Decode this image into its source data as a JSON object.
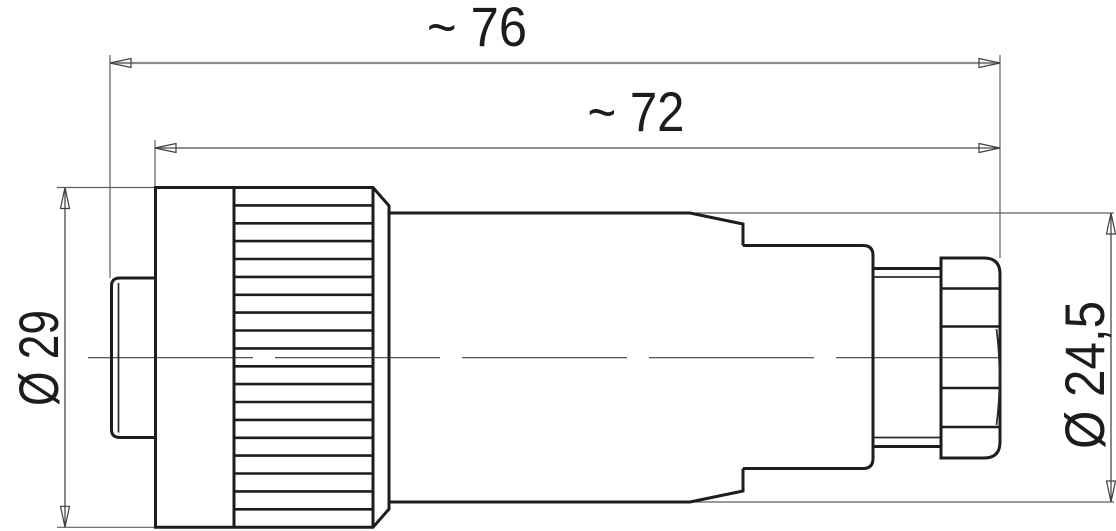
{
  "drawing": {
    "kind": "connector-dimension-drawing",
    "dimensions": {
      "overall_length": {
        "label": "~ 76"
      },
      "housing_length": {
        "label": "~ 72"
      },
      "front_diameter": {
        "label": "Ø 29"
      },
      "rear_diameter": {
        "label": "Ø 24,5"
      }
    },
    "colors": {
      "outline": "#1d1d1d",
      "construction_lines": "#5f5f5f",
      "background": "#ffffff"
    }
  }
}
